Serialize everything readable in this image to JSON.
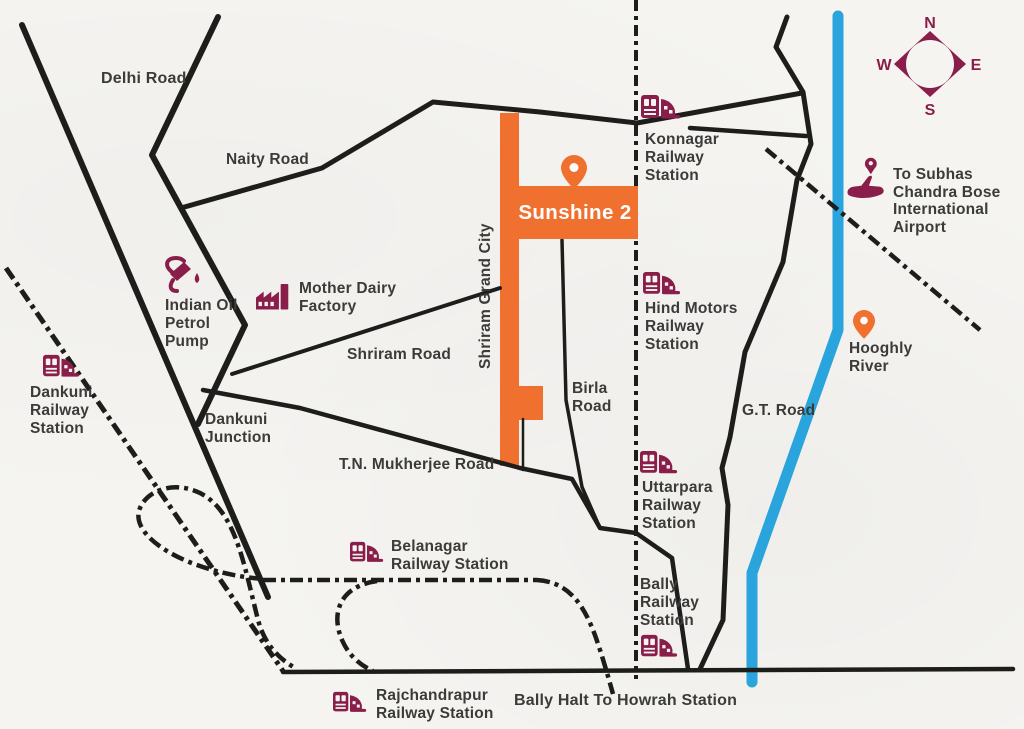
{
  "map": {
    "plot": {
      "name": "Sunshine 2"
    },
    "compass": {
      "n": "N",
      "e": "E",
      "s": "S",
      "w": "W"
    },
    "roads": {
      "delhi": "Delhi Road",
      "naity": "Naity Road",
      "shriram": "Shriram Road",
      "shriram_grand_city": "Shriram Grand City",
      "tn_mukherjee": "T.N. Mukherjee Road",
      "birla": "Birla\nRoad",
      "gt": "G.T. Road",
      "dankuni_junction": "Dankuni\nJunction",
      "bally_halt": "Bally Halt To Howrah Station"
    },
    "stations": {
      "konnagar": "Konnagar\nRailway\nStation",
      "hind_motors": "Hind Motors\nRailway\nStation",
      "uttarpara": "Uttarpara\nRailway\nStation",
      "bally": "Bally\nRailway\nStation",
      "dankuni": "Dankuni\nRailway\nStation",
      "belanagar": "Belanagar\nRailway Station",
      "rajchandrapur": "Rajchandrapur\nRailway Station"
    },
    "landmarks": {
      "indian_oil": "Indian Oil\nPetrol\nPump",
      "mother_dairy": "Mother Dairy\nFactory",
      "airport": "To Subhas\nChandra Bose\nInternational\nAirport",
      "hooghly": "Hooghly\nRiver"
    },
    "icons": {
      "station": "train-icon",
      "petrol_pump": "fuel-pump-icon",
      "factory": "factory-icon",
      "airport": "airplane-pin-icon",
      "location_pin": "map-pin-icon",
      "compass": "compass-rose-icon"
    },
    "colors": {
      "accent_orange": "#f0712f",
      "brand_maroon": "#8a1e4a",
      "river_blue": "#2aa4dc",
      "road_black": "#1d1d1b",
      "text_gray": "#3b3b3a"
    }
  }
}
